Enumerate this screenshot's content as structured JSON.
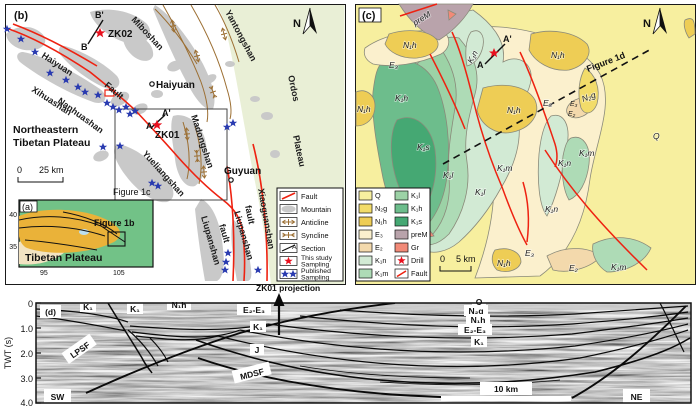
{
  "colors": {
    "fault_red": "#ee2211",
    "mountain_gray": "#c9c9c9",
    "fold_brown": "#9c6f33",
    "star_blue": "#2a3bb0",
    "star_red": "#e8101e",
    "ordos_green": "#e9efd6",
    "q_yellow": "#f7ef9f",
    "n2g_yellow": "#f2dc6a",
    "n1h_yellow": "#eecd55",
    "e3_cream": "#fbf0cd",
    "e2_tan": "#f3d9ac",
    "k1n_green": "#d2ead4",
    "k1m_green": "#aedbb6",
    "k1l_green": "#9cd2a6",
    "k1h_green": "#6dbd8c",
    "k1s_green": "#45a873",
    "prem_mauve": "#b9a3ab",
    "gr_salmon": "#f28a78"
  },
  "panel_b": {
    "tag": "(b)",
    "north": "N",
    "region_line1": "Northeastern",
    "region_line2": "Tibetan Plateau",
    "ordos_line1": "Ordos",
    "ordos_line2": "Plateau",
    "names": {
      "haiyuan_mtn": "Haiyuan",
      "fault_word": "Fault",
      "xihuashan": "Xihuashan",
      "nanhuashan": "Nanhuashan",
      "miboshan": "Miboshan",
      "yantongshan": "Yantongshan",
      "madongshan": "Madongshan",
      "yueliangshan": "Yueliangshan",
      "liupanshan": "Liupanshan",
      "fault_word2": "fault",
      "xiaoguanshan": "Xiaoguanshan"
    },
    "towns": {
      "haiyuan": "Haiyuan",
      "guyuan": "Guyuan"
    },
    "wells": {
      "zk01": "ZK01",
      "zk02": "ZK02"
    },
    "section_points": {
      "a": "A",
      "a_prime": "A'",
      "b": "B",
      "b_prime": "B'"
    },
    "scale": {
      "zero": "0",
      "label": "25 km"
    },
    "figure_ref_c": "Figure 1c",
    "legend": {
      "fault": "Fault",
      "mountain": "Mountain",
      "anticline": "Anticline",
      "syncline": "Syncline",
      "section": "Section",
      "section_mark": "A",
      "this_study_line1": "This study",
      "this_study_line2": "Sampling",
      "published_line1": "Published",
      "published_line2": "Sampling"
    }
  },
  "inset_a": {
    "tag": "(a)",
    "label": "Tibetan Plateau",
    "figure_ref": "Figure 1b",
    "lat_ticks": [
      "40",
      "35"
    ],
    "lon_ticks": [
      "95",
      "105"
    ]
  },
  "panel_c": {
    "tag": "(c)",
    "north": "N",
    "figure_ref_d": "Figure 1d",
    "scale": {
      "zero": "0",
      "label": "5 km"
    },
    "section_points": {
      "a": "A",
      "a_prime": "A'"
    },
    "units": {
      "q": "Q",
      "n2g": "N₂g",
      "n1h": "N₁h",
      "e3": "E₃",
      "e2": "E₂",
      "k1n": "K₁n",
      "k1m": "K₁m",
      "k1l": "K₁l",
      "k1h": "K₁h",
      "k1s": "K₁s",
      "prem": "preM",
      "gr": "Gr"
    },
    "legend": {
      "drill": "Drill",
      "fault": "Fault"
    }
  },
  "panel_d": {
    "tag": "(d)",
    "axis_label": "TWT (s)",
    "ticks": [
      "0",
      "1.0",
      "2.0",
      "3.0",
      "4.0"
    ],
    "units": {
      "k1": "K₁",
      "n1h": "N₁h",
      "e2e3": "E₂-E₃",
      "j": "J",
      "q": "Q",
      "n2g": "N₂g"
    },
    "faults": {
      "lpsf": "LPSF",
      "mdsf": "MDSF"
    },
    "directions": {
      "sw": "SW",
      "ne": "NE"
    },
    "scale_label": "10 km",
    "annotation": "ZK01 projection"
  }
}
